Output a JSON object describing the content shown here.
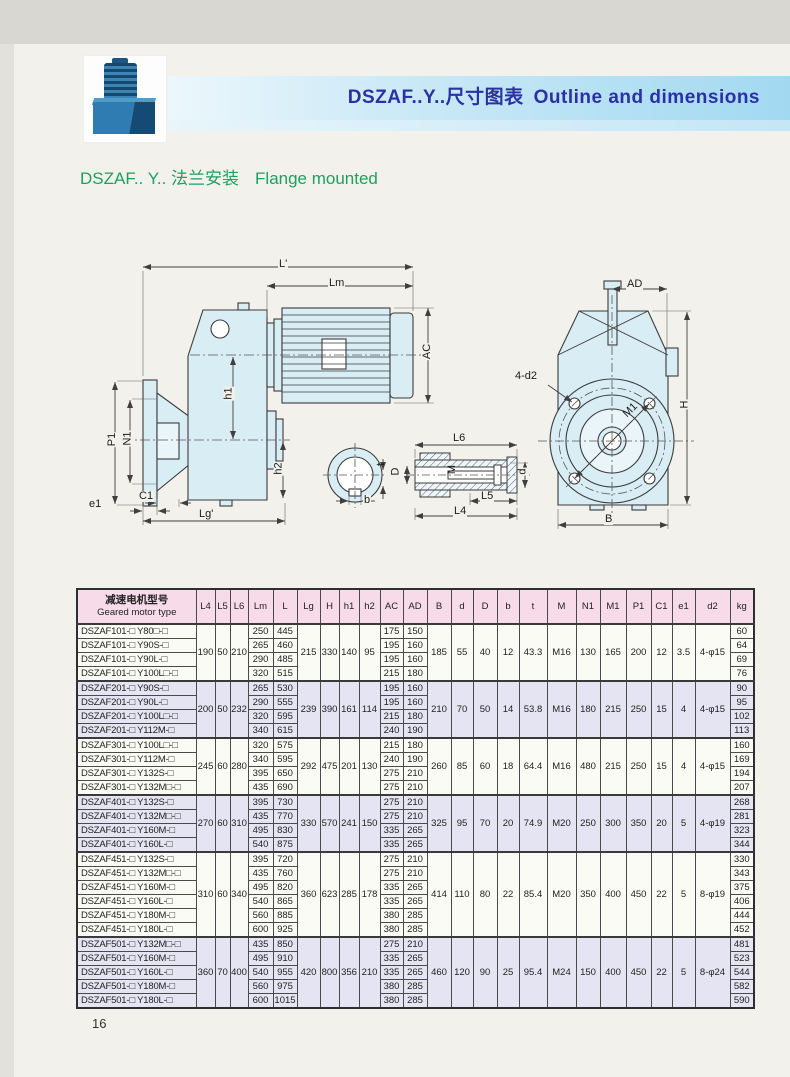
{
  "header": {
    "title_zh": "DSZAF..Y..尺寸图表",
    "title_en": "Outline and dimensions",
    "subtitle_zh": "DSZAF.. Y.. 法兰安装",
    "subtitle_en": "Flange mounted",
    "title_color": "#2b31a5",
    "subtitle_color": "#1ea05e",
    "band_color": "#a2d9f1"
  },
  "page": {
    "number": "16"
  },
  "drawing": {
    "labels": [
      "L'",
      "Lm",
      "AC",
      "h1",
      "h2",
      "P1",
      "N1",
      "e1",
      "C1",
      "Lg'",
      "b",
      "t",
      "L6",
      "D",
      "M",
      "d",
      "L5",
      "L4",
      "AD",
      "H",
      "B",
      "4-d2",
      "M1"
    ]
  },
  "table": {
    "header": {
      "model_zh": "减速电机型号",
      "model_en": "Geared motor type",
      "cols": [
        "L4",
        "L5",
        "L6",
        "Lm",
        "L",
        "Lg",
        "H",
        "h1",
        "h2",
        "AC",
        "AD",
        "B",
        "d",
        "D",
        "b",
        "t",
        "M",
        "N1",
        "M1",
        "P1",
        "C1",
        "e1",
        "d2",
        "kg"
      ]
    },
    "groups": [
      {
        "series": "DSZAF101",
        "shared": {
          "L4": "190",
          "L5": "50",
          "L6": "210",
          "Lg": "215",
          "H": "330",
          "h1": "140",
          "h2": "95",
          "B": "185",
          "d": "55",
          "D": "40",
          "b": "12",
          "t": "43.3",
          "M": "M16",
          "N1": "130",
          "M1": "165",
          "P1": "200",
          "C1": "12",
          "e1": "3.5",
          "d2": "4-φ15"
        },
        "rows": [
          {
            "model": "DSZAF101-□ Y80□-□",
            "Lm": "250",
            "L": "445",
            "AC": "175",
            "AD": "150",
            "kg": "60"
          },
          {
            "model": "DSZAF101-□ Y90S-□",
            "Lm": "265",
            "L": "460",
            "AC": "195",
            "AD": "160",
            "kg": "64"
          },
          {
            "model": "DSZAF101-□ Y90L-□",
            "Lm": "290",
            "L": "485",
            "AC": "195",
            "AD": "160",
            "kg": "69"
          },
          {
            "model": "DSZAF101-□ Y100L□-□",
            "Lm": "320",
            "L": "515",
            "AC": "215",
            "AD": "180",
            "kg": "76"
          }
        ]
      },
      {
        "series": "DSZAF201",
        "shared": {
          "L4": "200",
          "L5": "50",
          "L6": "232",
          "Lg": "239",
          "H": "390",
          "h1": "161",
          "h2": "114",
          "B": "210",
          "d": "70",
          "D": "50",
          "b": "14",
          "t": "53.8",
          "M": "M16",
          "N1": "180",
          "M1": "215",
          "P1": "250",
          "C1": "15",
          "e1": "4",
          "d2": "4-φ15"
        },
        "rows": [
          {
            "model": "DSZAF201-□ Y90S-□",
            "Lm": "265",
            "L": "530",
            "AC": "195",
            "AD": "160",
            "kg": "90"
          },
          {
            "model": "DSZAF201-□ Y90L-□",
            "Lm": "290",
            "L": "555",
            "AC": "195",
            "AD": "160",
            "kg": "95"
          },
          {
            "model": "DSZAF201-□ Y100L□-□",
            "Lm": "320",
            "L": "595",
            "AC": "215",
            "AD": "180",
            "kg": "102"
          },
          {
            "model": "DSZAF201-□ Y112M-□",
            "Lm": "340",
            "L": "615",
            "AC": "240",
            "AD": "190",
            "kg": "113"
          }
        ]
      },
      {
        "series": "DSZAF301",
        "shared": {
          "L4": "245",
          "L5": "60",
          "L6": "280",
          "Lg": "292",
          "H": "475",
          "h1": "201",
          "h2": "130",
          "B": "260",
          "d": "85",
          "D": "60",
          "b": "18",
          "t": "64.4",
          "M": "M16",
          "N1": "480",
          "M1": "215",
          "P1": "250",
          "C1": "15",
          "e1": "4",
          "d2": "4-φ15"
        },
        "rows": [
          {
            "model": "DSZAF301-□ Y100L□-□",
            "Lm": "320",
            "L": "575",
            "AC": "215",
            "AD": "180",
            "kg": "160"
          },
          {
            "model": "DSZAF301-□ Y112M-□",
            "Lm": "340",
            "L": "595",
            "AC": "240",
            "AD": "190",
            "kg": "169"
          },
          {
            "model": "DSZAF301-□ Y132S-□",
            "Lm": "395",
            "L": "650",
            "AC": "275",
            "AD": "210",
            "kg": "194"
          },
          {
            "model": "DSZAF301-□ Y132M□-□",
            "Lm": "435",
            "L": "690",
            "AC": "275",
            "AD": "210",
            "kg": "207"
          }
        ]
      },
      {
        "series": "DSZAF401",
        "shared": {
          "L4": "270",
          "L5": "60",
          "L6": "310",
          "Lg": "330",
          "H": "570",
          "h1": "241",
          "h2": "150",
          "B": "325",
          "d": "95",
          "D": "70",
          "b": "20",
          "t": "74.9",
          "M": "M20",
          "N1": "250",
          "M1": "300",
          "P1": "350",
          "C1": "20",
          "e1": "5",
          "d2": "4-φ19"
        },
        "rows": [
          {
            "model": "DSZAF401-□ Y132S-□",
            "Lm": "395",
            "L": "730",
            "AC": "275",
            "AD": "210",
            "kg": "268"
          },
          {
            "model": "DSZAF401-□ Y132M□-□",
            "Lm": "435",
            "L": "770",
            "AC": "275",
            "AD": "210",
            "kg": "281"
          },
          {
            "model": "DSZAF401-□ Y160M-□",
            "Lm": "495",
            "L": "830",
            "AC": "335",
            "AD": "265",
            "kg": "323"
          },
          {
            "model": "DSZAF401-□ Y160L-□",
            "Lm": "540",
            "L": "875",
            "AC": "335",
            "AD": "265",
            "kg": "344"
          }
        ]
      },
      {
        "series": "DSZAF451",
        "shared": {
          "L4": "310",
          "L5": "60",
          "L6": "340",
          "Lg": "360",
          "H": "623",
          "h1": "285",
          "h2": "178",
          "B": "414",
          "d": "110",
          "D": "80",
          "b": "22",
          "t": "85.4",
          "M": "M20",
          "N1": "350",
          "M1": "400",
          "P1": "450",
          "C1": "22",
          "e1": "5",
          "d2": "8-φ19"
        },
        "rows": [
          {
            "model": "DSZAF451-□ Y132S-□",
            "Lm": "395",
            "L": "720",
            "AC": "275",
            "AD": "210",
            "kg": "330"
          },
          {
            "model": "DSZAF451-□ Y132M□-□",
            "Lm": "435",
            "L": "760",
            "AC": "275",
            "AD": "210",
            "kg": "343"
          },
          {
            "model": "DSZAF451-□ Y160M-□",
            "Lm": "495",
            "L": "820",
            "AC": "335",
            "AD": "265",
            "kg": "375"
          },
          {
            "model": "DSZAF451-□ Y160L-□",
            "Lm": "540",
            "L": "865",
            "AC": "335",
            "AD": "265",
            "kg": "406"
          },
          {
            "model": "DSZAF451-□ Y180M-□",
            "Lm": "560",
            "L": "885",
            "AC": "380",
            "AD": "285",
            "kg": "444"
          },
          {
            "model": "DSZAF451-□ Y180L-□",
            "Lm": "600",
            "L": "925",
            "AC": "380",
            "AD": "285",
            "kg": "452"
          }
        ]
      },
      {
        "series": "DSZAF501",
        "shared": {
          "L4": "360",
          "L5": "70",
          "L6": "400",
          "Lg": "420",
          "H": "800",
          "h1": "356",
          "h2": "210",
          "B": "460",
          "d": "120",
          "D": "90",
          "b": "25",
          "t": "95.4",
          "M": "M24",
          "N1": "150",
          "M1": "400",
          "P1": "450",
          "C1": "22",
          "e1": "5",
          "d2": "8-φ24"
        },
        "rows": [
          {
            "model": "DSZAF501-□ Y132M□-□",
            "Lm": "435",
            "L": "850",
            "AC": "275",
            "AD": "210",
            "kg": "481"
          },
          {
            "model": "DSZAF501-□ Y160M-□",
            "Lm": "495",
            "L": "910",
            "AC": "335",
            "AD": "265",
            "kg": "523"
          },
          {
            "model": "DSZAF501-□ Y160L-□",
            "Lm": "540",
            "L": "955",
            "AC": "335",
            "AD": "265",
            "kg": "544"
          },
          {
            "model": "DSZAF501-□ Y180M-□",
            "Lm": "560",
            "L": "975",
            "AC": "380",
            "AD": "285",
            "kg": "582"
          },
          {
            "model": "DSZAF501-□ Y180L-□",
            "Lm": "600",
            "L": "1015",
            "AC": "380",
            "AD": "285",
            "kg": "590"
          }
        ]
      }
    ]
  }
}
